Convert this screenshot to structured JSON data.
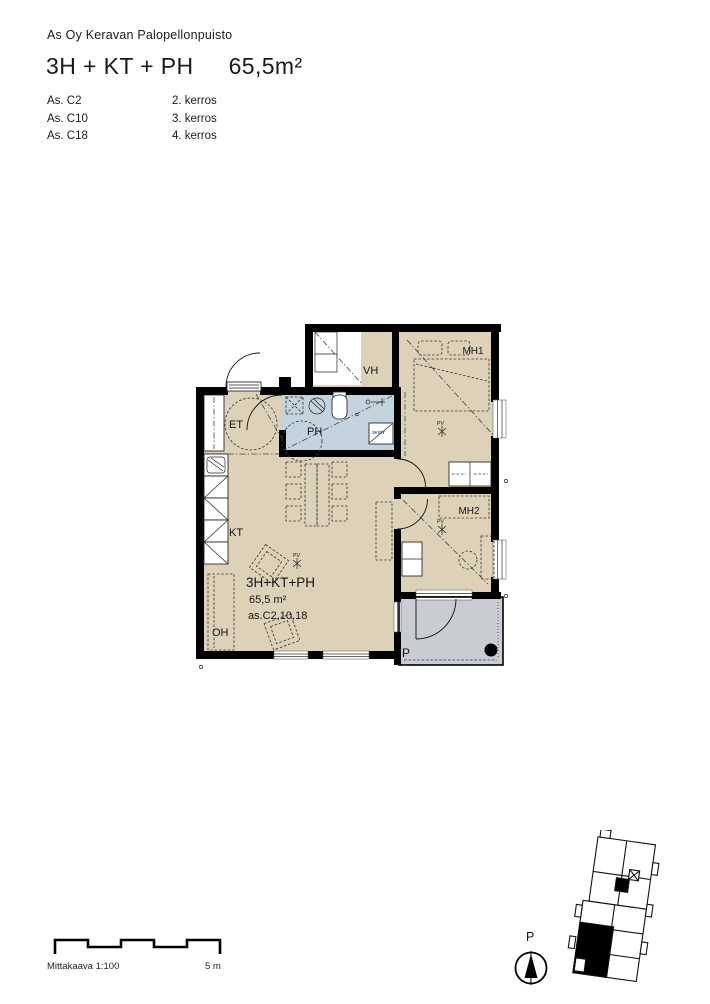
{
  "header": {
    "project": "As Oy Keravan Palopellonpuisto",
    "apartment_type": "3H + KT + PH",
    "area": "65,5m²",
    "units": [
      {
        "apartment": "As. C2",
        "floor": "2. kerros"
      },
      {
        "apartment": "As. C10",
        "floor": "3. kerros"
      },
      {
        "apartment": "As. C18",
        "floor": "4. kerros"
      }
    ]
  },
  "plan": {
    "labels": {
      "entrance": "ET",
      "bathroom": "PH",
      "walkin_closet": "VH",
      "bedroom1": "MH1",
      "bedroom2": "MH2",
      "kitchen": "KT",
      "living_room": "OH",
      "balcony": "P"
    },
    "annotation": {
      "type": "3H+KT+PH",
      "area": "65,5 m²",
      "apartments": "as.C2,10,18"
    },
    "markers": {
      "radiator": "PV",
      "sk_py": "SK/PY",
      "drain": "¤"
    },
    "colors": {
      "room_fill": "#ddd2b7",
      "bathroom_fill": "#c4d4de",
      "balcony_fill": "#c9cdd1",
      "wall": "#000000"
    }
  },
  "footer": {
    "scale_label": "Mittakaava 1:100",
    "scale_end_label": "5 m",
    "north_label": "P"
  }
}
